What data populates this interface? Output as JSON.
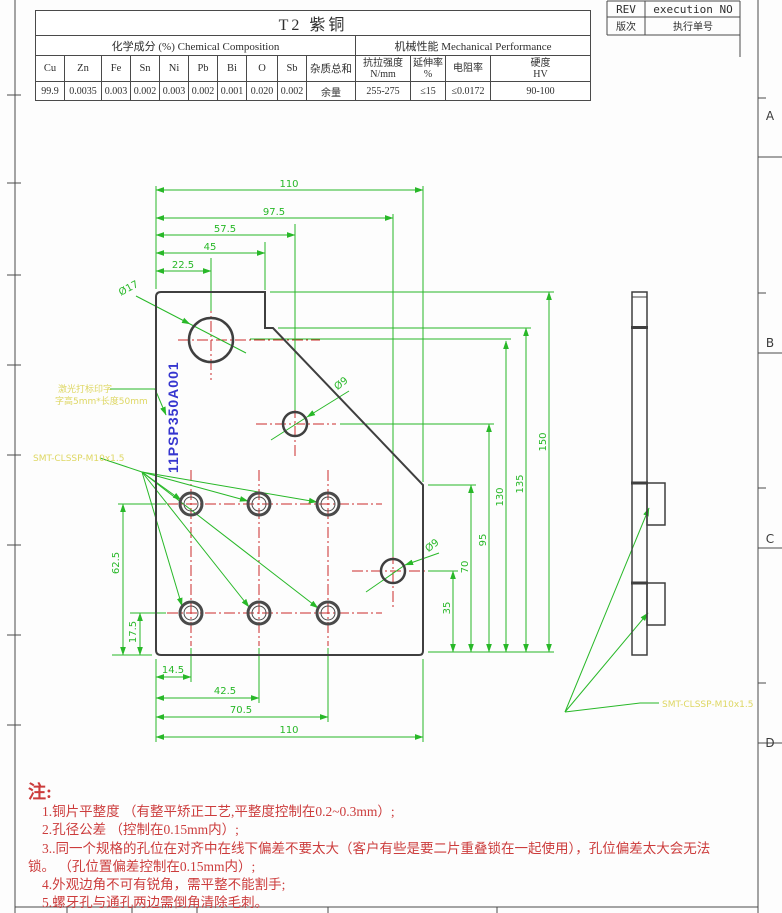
{
  "rev_block": {
    "rev": "REV",
    "execution": "execution NO",
    "rev_value": "版次",
    "execution_value": "执行单号"
  },
  "zones": [
    "A",
    "B",
    "C",
    "D"
  ],
  "material_table": {
    "title": "T2 紫铜",
    "chem_header": "化学成分 (%) Chemical Composition",
    "mech_header": "机械性能 Mechanical Performance",
    "chem_columns": [
      "Cu",
      "Zn",
      "Fe",
      "Sn",
      "Ni",
      "Pb",
      "Bi",
      "O",
      "Sb",
      "杂质总和"
    ],
    "chem_values": [
      "99.9",
      "0.0035",
      "0.003",
      "0.002",
      "0.003",
      "0.002",
      "0.001",
      "0.020",
      "0.002",
      "余量"
    ],
    "mech_columns": [
      {
        "l1": "抗拉强度",
        "l2": "N/mm"
      },
      {
        "l1": "延伸率",
        "l2": "%"
      },
      {
        "l1": "电阻率",
        "l2": ""
      },
      {
        "l1": "硬度",
        "l2": "HV"
      }
    ],
    "mech_values": [
      "255-275",
      "≤15",
      "≤0.0172",
      "90-100"
    ]
  },
  "drawing": {
    "dims_top": [
      "110",
      "97.5",
      "57.5",
      "45",
      "22.5"
    ],
    "dims_right": [
      "150",
      "135",
      "130",
      "95",
      "70",
      "35"
    ],
    "dims_left": [
      "62.5",
      "17.5"
    ],
    "dims_bottom": [
      "14.5",
      "42.5",
      "70.5",
      "110"
    ],
    "hole_big": "Ø17",
    "hole_mid": "Ø9",
    "hole_low": "Ø9",
    "part_number": "11PSP350A001",
    "laser_note_1": "激光打标印字",
    "laser_note_2": "字高5mm*长度50mm",
    "thread_note": "SMT-CLSSP-M10x1.5",
    "thread_note_side": "SMT-CLSSP-M10x1.5"
  },
  "notes": {
    "title": "注:",
    "items": [
      "1.铜片平整度 （有整平矫正工艺,平整度控制在0.2~0.3mm）;",
      "2.孔径公差 （控制在0.15mm内）;",
      "3..同一个规格的孔位在对齐中在线下偏差不要太大（客户有些是要二片重叠锁在一起使用），孔位偏差太大会无法锁。 （孔位置偏差控制在0.15mm内）;",
      "4.外观边角不可有锐角，需平整不能割手;",
      "5.螺牙孔与通孔两边需倒角清除毛刺。"
    ]
  },
  "colors": {
    "dimension_green": "#28b828",
    "centerline_red": "#cc2a2a",
    "notes_red": "#cc3c3c",
    "outline_gray": "#3f3f3f",
    "part_number_blue": "#3636cf",
    "annotation_yellow": "#ded763"
  }
}
